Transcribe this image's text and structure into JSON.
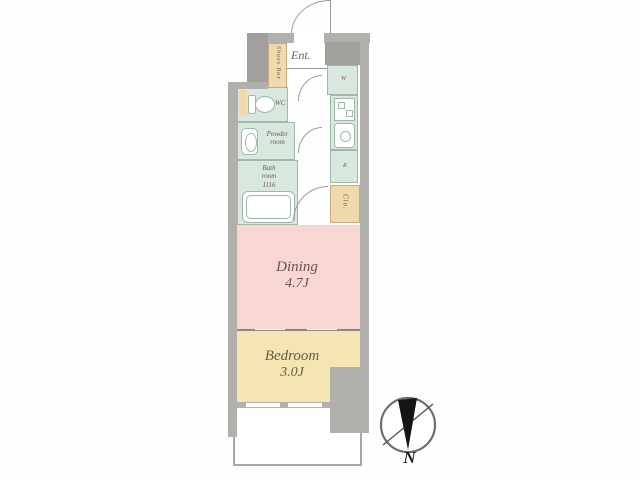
{
  "floorplan": {
    "entrance": {
      "label": "Ent."
    },
    "shoes_box": {
      "label": "Shoes Box"
    },
    "wc": {
      "label": "WC"
    },
    "powder_room": {
      "lines": [
        "Powder",
        "room"
      ]
    },
    "bath_room": {
      "lines": [
        "Bath",
        "room",
        "1116"
      ]
    },
    "washer": {
      "label": "W"
    },
    "refrigerator": {
      "label": "R"
    },
    "closet": {
      "label": "Clo."
    },
    "dining": {
      "name": "Dining",
      "area": "4.7J"
    },
    "bedroom": {
      "name": "Bedroom",
      "area": "3.0J"
    },
    "compass": {
      "label": "N"
    }
  },
  "colors": {
    "wall": "#b2b0ad",
    "wall_dark": "#a09f9c",
    "room_green": "#d8e8de",
    "green_border": "#9fb8a8",
    "cabinet_tan": "#f0d9ad",
    "tan_border": "#c6ab7c",
    "dining_pink": "#f8d6d2",
    "bedroom_yellow": "#f4e6b3",
    "partition": "#8d857b",
    "line_gray": "#9b9b9b",
    "label_text": "#6b5a52",
    "compass_black": "#1b1b1b"
  }
}
